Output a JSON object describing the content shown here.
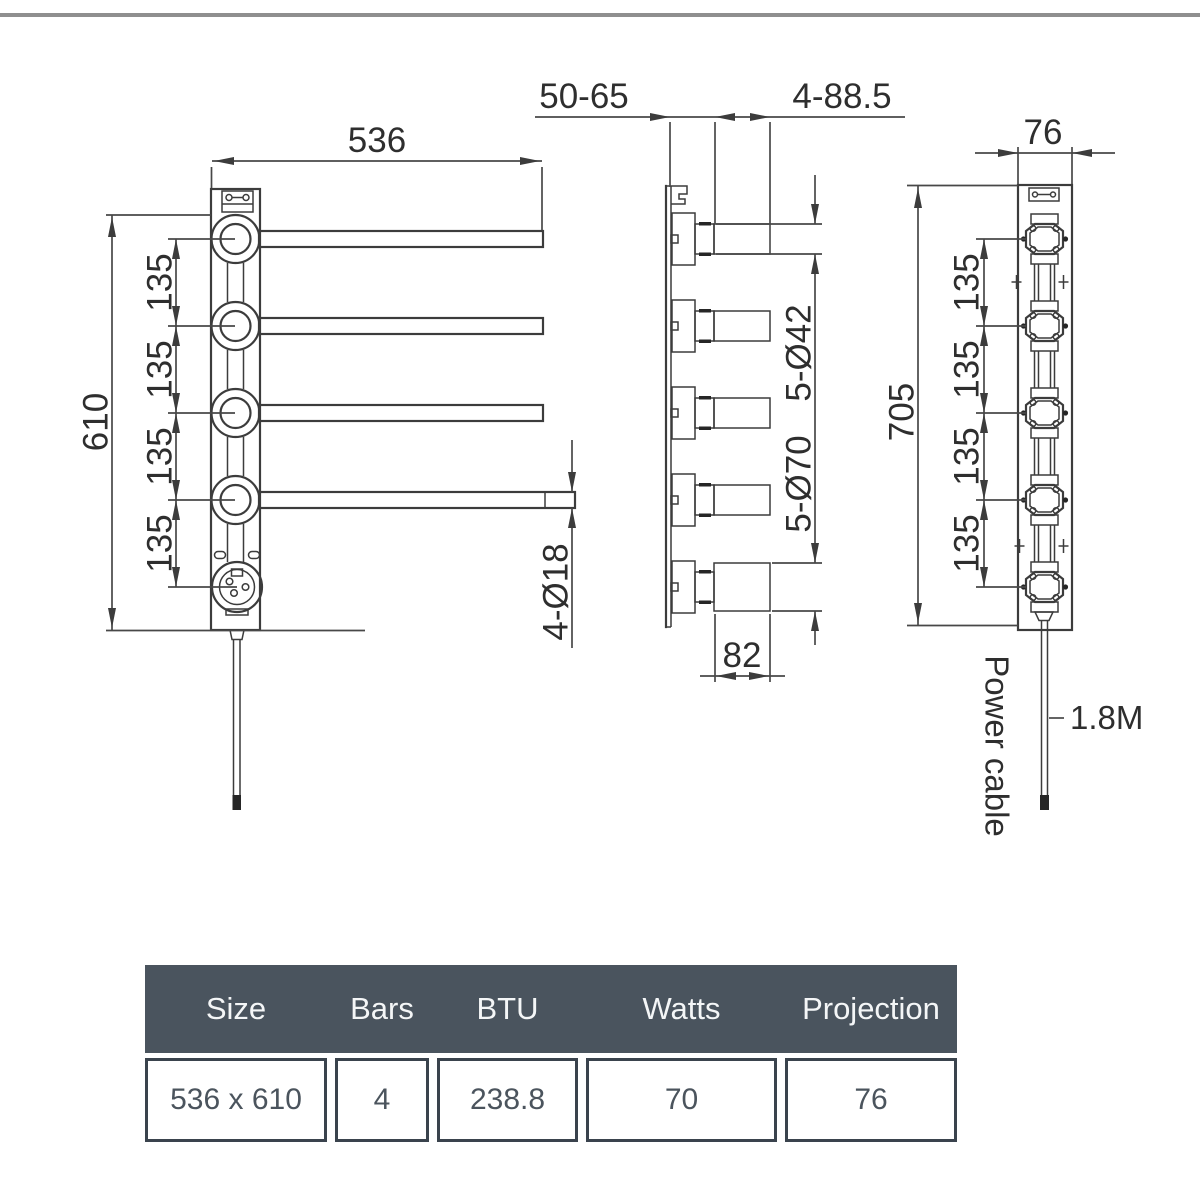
{
  "drawing": {
    "front_view": {
      "width_dim": "536",
      "height_dim": "610",
      "spacing_dims": [
        "135",
        "135",
        "135",
        "135"
      ],
      "bar_diameter_dim": "4-Ø18"
    },
    "side_view": {
      "wall_distance_dim": "50-65",
      "hole_offset_dim": "4-88.5",
      "barrel_diameter_dim": "5-Ø42",
      "disc_diameter_dim": "5-Ø70",
      "block_width_dim": "82"
    },
    "back_view": {
      "depth_dim": "76",
      "height_dim": "705",
      "spacing_dims": [
        "135",
        "135",
        "135",
        "135"
      ],
      "power_cable_label": "Power cable",
      "cable_length_label": "1.8M"
    }
  },
  "spec_table": {
    "columns": [
      {
        "header": "Size",
        "value": "536 x 610"
      },
      {
        "header": "Bars",
        "value": "4"
      },
      {
        "header": "BTU",
        "value": "238.8"
      },
      {
        "header": "Watts",
        "value": "70"
      },
      {
        "header": "Projection",
        "value": "76"
      }
    ],
    "header_bg": "#4a545e",
    "border_color": "#3a434d",
    "value_text_color": "#4b545d"
  },
  "colors": {
    "line": "#3c3c3c",
    "top_border": "#8f8f8f",
    "background": "#ffffff"
  }
}
